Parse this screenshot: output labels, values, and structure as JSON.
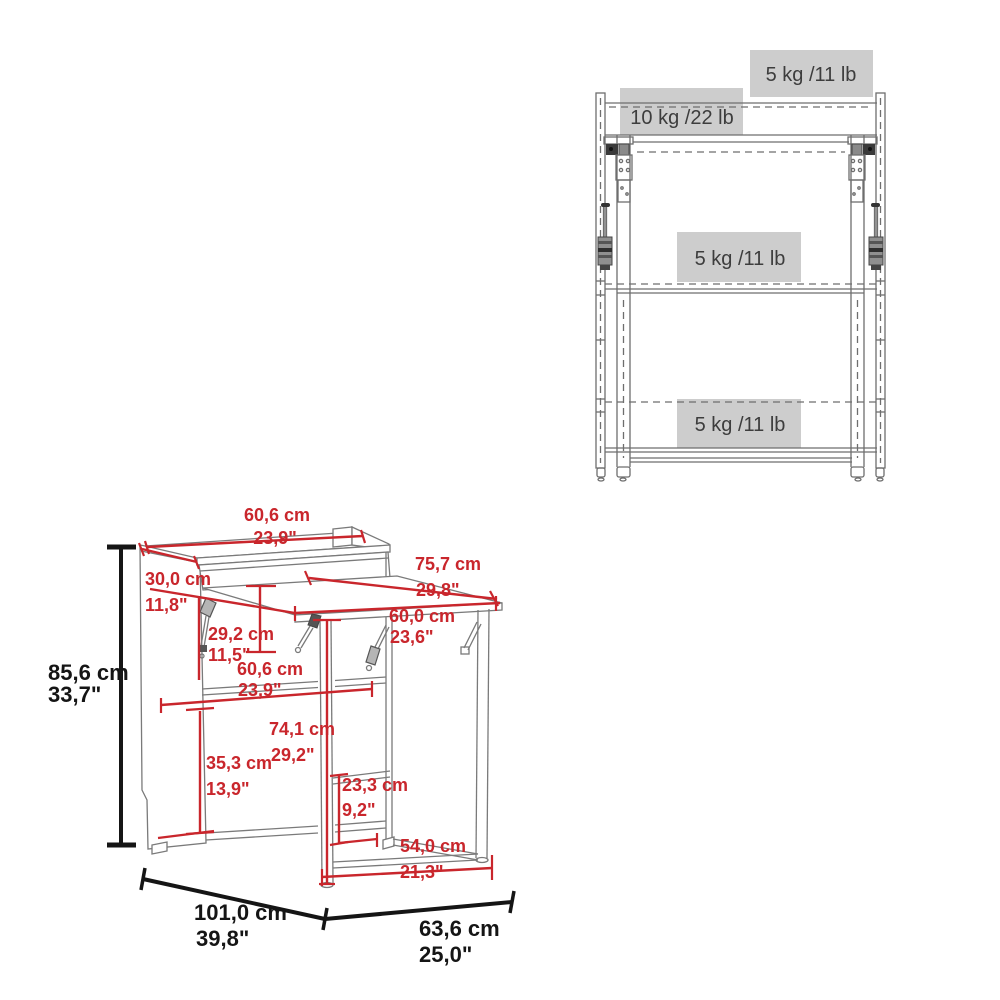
{
  "diagram": {
    "title": "folding-desk dimension diagram",
    "colors": {
      "dimension_red": "#c9262c",
      "overall_black": "#151515",
      "structure_gray": "#6e6e6e",
      "capacity_box": "#cdcdcd",
      "capacity_text": "#3d3d3d"
    }
  },
  "front_view": {
    "capacity_labels": [
      {
        "area": "top-surface",
        "text": "5 kg /11 lb"
      },
      {
        "area": "upper-shelf",
        "text": "10 kg /22 lb"
      },
      {
        "area": "middle-shelf",
        "text": "5 kg /11 lb"
      },
      {
        "area": "bottom-shelf",
        "text": "5 kg /11 lb"
      }
    ]
  },
  "iso_view": {
    "red_dimensions": [
      {
        "part": "hutch-top-width",
        "cm": "60,6 cm",
        "inch": "23,9\""
      },
      {
        "part": "desk-surface-depth",
        "cm": "75,7 cm",
        "inch": "29,8\""
      },
      {
        "part": "side-panel-depth",
        "cm": "30,0 cm",
        "inch": "11,8\""
      },
      {
        "part": "fold-bracket-drop",
        "cm": "29,2 cm",
        "inch": "11,5\""
      },
      {
        "part": "desk-surface-width",
        "cm": "60,0 cm",
        "inch": "23,6\""
      },
      {
        "part": "shelf-width",
        "cm": "60,6 cm",
        "inch": "23,9\""
      },
      {
        "part": "desk-height",
        "cm": "74,1 cm",
        "inch": "29,2\""
      },
      {
        "part": "shelf-spacing",
        "cm": "35,3 cm",
        "inch": "13,9\""
      },
      {
        "part": "stretcher-height",
        "cm": "23,3 cm",
        "inch": "9,2\""
      },
      {
        "part": "stretcher-width",
        "cm": "54,0 cm",
        "inch": "21,3\""
      }
    ],
    "black_dimensions": [
      {
        "part": "overall-height",
        "cm": "85,6 cm",
        "inch": "33,7\""
      },
      {
        "part": "overall-depth",
        "cm": "101,0 cm",
        "inch": "39,8\""
      },
      {
        "part": "overall-width",
        "cm": "63,6 cm",
        "inch": "25,0\""
      }
    ]
  }
}
